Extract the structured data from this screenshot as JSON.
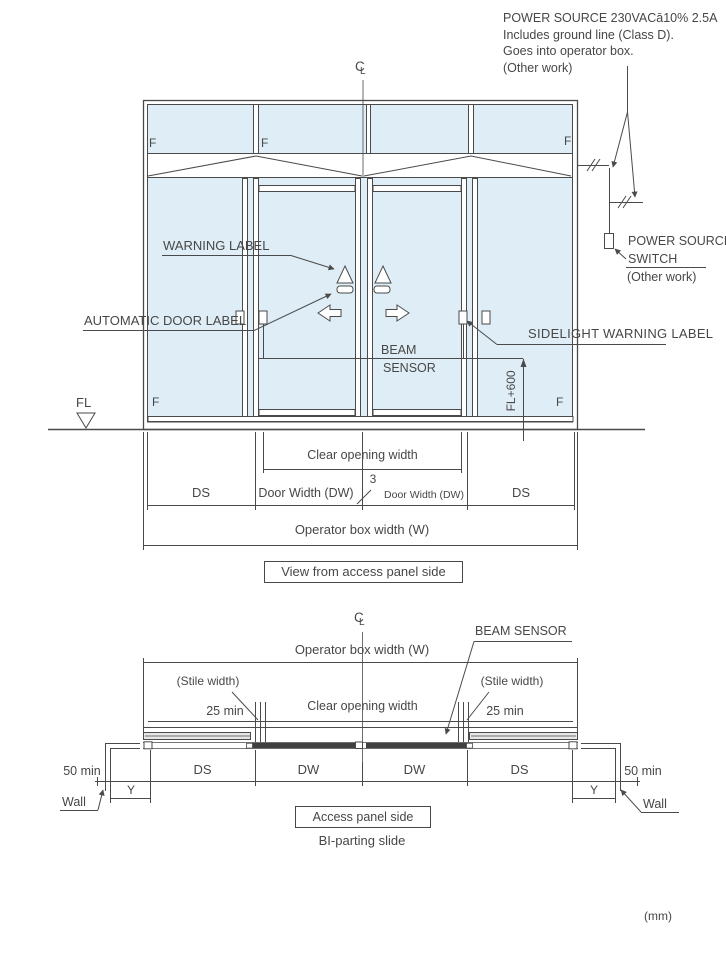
{
  "colors": {
    "glass": "#dfeef6",
    "line": "#4a4a4a"
  },
  "units_note": "(mm)",
  "power_note": {
    "line1": "POWER SOURCE 230VACā10% 2.5A",
    "line2": "Includes ground line (Class D).",
    "line3": "Goes into operator box.",
    "line4": "(Other work)"
  },
  "power_switch": {
    "line1": "POWER SOURCE",
    "line2": "SWITCH",
    "line3": "(Other work)"
  },
  "centerline": {
    "c": "C",
    "l": "L"
  },
  "elevation": {
    "f_label": "F",
    "warning_label": "WARNING LABEL",
    "automatic_door_label": "AUTOMATIC DOOR LABEL",
    "beam_sensor_line1": "BEAM",
    "beam_sensor_line2": "SENSOR",
    "sidelight_warning_label": "SIDELIGHT WARNING LABEL",
    "fl_label": "FL",
    "fl600_label": "FL+600",
    "dims": {
      "clear_opening": "Clear opening width",
      "ds_left": "DS",
      "door_width_left": "Door Width (DW)",
      "gap": "3",
      "door_width_right": "Door Width (DW)",
      "ds_right": "DS",
      "operator_box": "Operator box width (W)"
    },
    "caption": "View from access panel side"
  },
  "plan": {
    "beam_sensor": "BEAM SENSOR",
    "operator_box": "Operator box width (W)",
    "stile_width_left": "(Stile width)",
    "stile_width_right": "(Stile width)",
    "min25_left": "25 min",
    "min25_right": "25 min",
    "clear_opening": "Clear opening width",
    "min50_left": "50 min",
    "min50_right": "50 min",
    "ds_left": "DS",
    "dw_left": "DW",
    "dw_right": "DW",
    "ds_right": "DS",
    "y_left": "Y",
    "y_right": "Y",
    "wall_left": "Wall",
    "wall_right": "Wall",
    "caption": "Access panel side",
    "subcaption": "BI-parting slide"
  }
}
